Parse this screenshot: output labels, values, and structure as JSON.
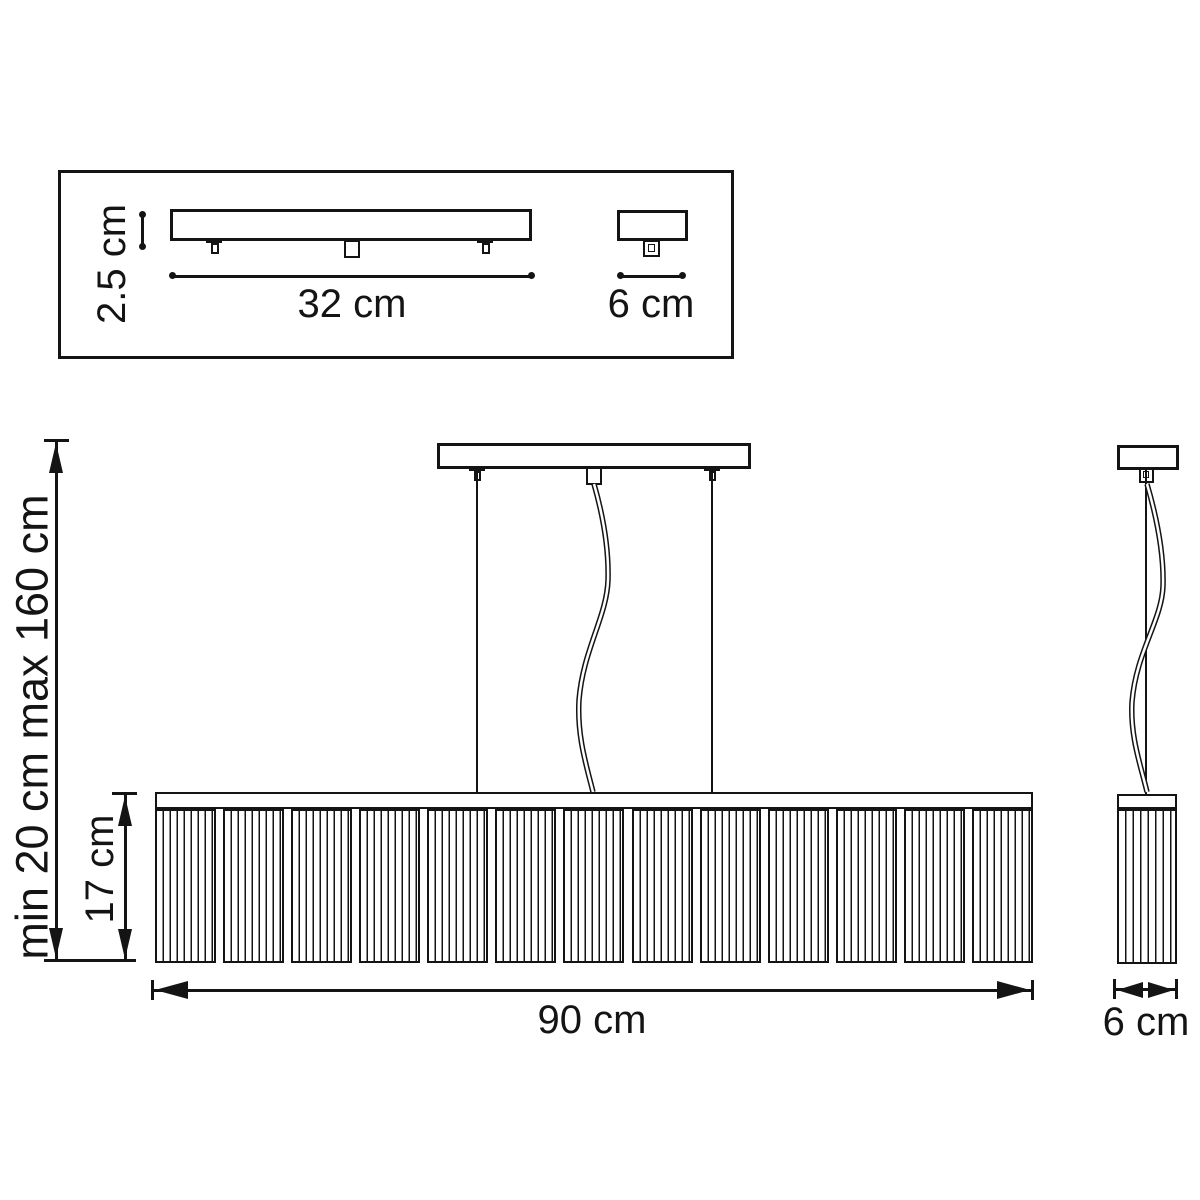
{
  "figure": {
    "type": "technical-dimension-drawing",
    "subject": "linear pendant chandelier with ceiling canopy",
    "line_color": "#141414",
    "background_color": "#ffffff",
    "canopy_detail": {
      "height_label": "2.5 cm",
      "length_label": "32 cm",
      "depth_label": "6 cm"
    },
    "front_view": {
      "suspension_height_label": "min 20 cm max 160 cm",
      "shade_height_label": "17 cm",
      "width_label": "90 cm"
    },
    "side_view": {
      "depth_label": "6 cm"
    }
  }
}
